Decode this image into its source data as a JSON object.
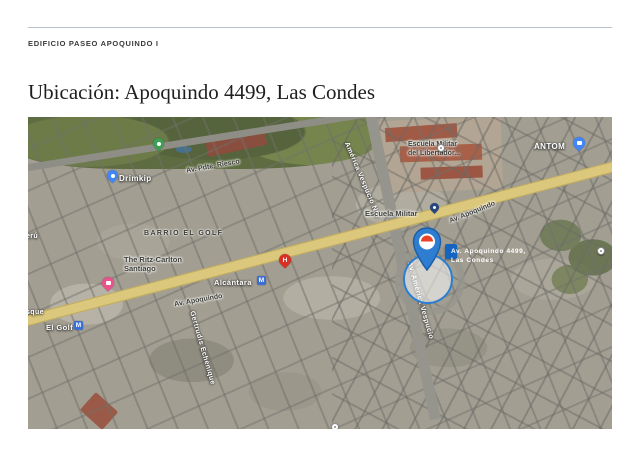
{
  "header": {
    "project_label": "EDIFICIO PASEO APOQUINDO I"
  },
  "title": "Ubicación: Apoquindo 4499, Las Condes",
  "map": {
    "tooltip": {
      "line1": "Av. Apoquindo 4499,",
      "line2": "Las Condes"
    },
    "streets": {
      "pdte_riesco": "Av. Pdte. Riesco",
      "apoquindo_west": "Av. Apoquindo",
      "apoquindo_east": "Av. Apoquindo",
      "america_vespucio_nte": "América Vespucio Nte",
      "av_america_vespucio": "Av. América Vespucio",
      "gertrudis_echenique": "Gertrudis Echenique",
      "peru_partial": "erú",
      "bosque_partial": "sque"
    },
    "places": {
      "neighborhood": "BARRIO EL GOLF",
      "drimkip": "Drimkip",
      "ritz_line1": "The Ritz-Carlton",
      "ritz_line2": "Santiago",
      "alcantara_station": "Alcántara",
      "el_golf_station": "El Golf",
      "escuela_militar_station": "Escuela Militar",
      "escuela_poi_line1": "Escuela Militar",
      "escuela_poi_line2": "del Libertador...",
      "antom": "ANTOM"
    },
    "glyphs": {
      "metro": "M",
      "hospital": "H"
    },
    "colors": {
      "accent_blue": "#1565c0",
      "pin_blue": "#2e7dd1",
      "metro_blue": "#3b6fd6",
      "hospital_red": "#d93025",
      "hotel_pink": "#e9538c",
      "poi_green": "#3f9e55",
      "road_yellow": "#dcc87c"
    }
  }
}
